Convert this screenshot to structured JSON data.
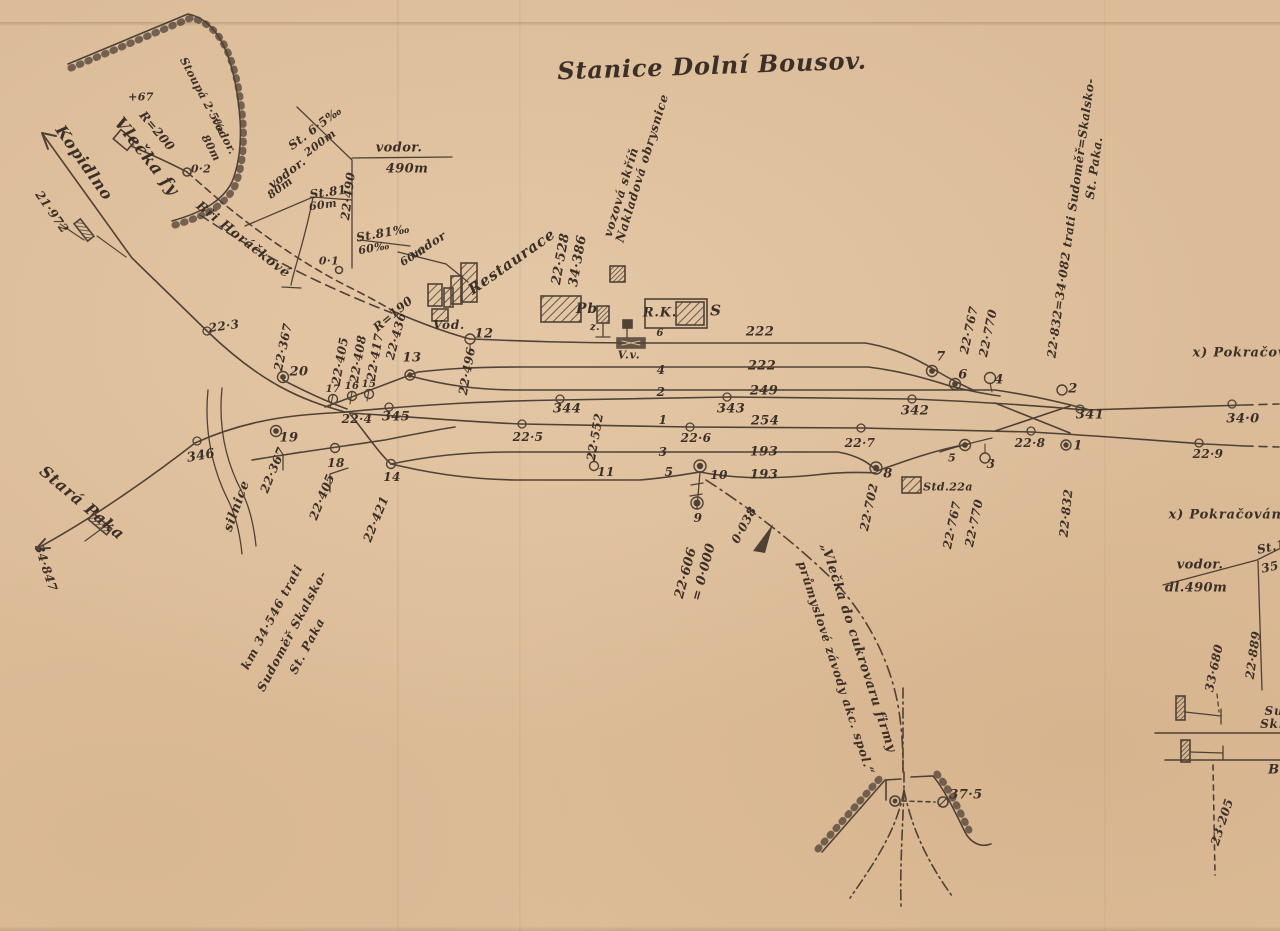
{
  "diagram": {
    "title": "Stanice Dolní Bousov.",
    "paper_color": "#dcbc98",
    "ink_color": "#3b3129",
    "type": "railway-station-track-plan"
  },
  "labels": {
    "title": "Stanice Dolní Bousov.",
    "kopidlno": "Kopidlno",
    "km_21_972": "21·972",
    "vlecka_fy": "Vlečka fy",
    "r_200": "R=200",
    "plus_67": "+67",
    "stoupa_2_5": "Stoupá 2·5‰",
    "vodor_a": "vodor.",
    "m_80_a": "80m",
    "bri_horackove": "Bři Horáčkové",
    "st_6_5": "St. 6·5‰",
    "m_200": "200m",
    "vodor_b": "vodor.",
    "m_490": "490m",
    "vodor_c": "vodor.",
    "m_80_b": "80m",
    "st_81_a": "St.81",
    "m_60_a": "60m",
    "km_22_490": "22·490",
    "st_81_b": "St.81‰",
    "per_60": "60‰",
    "vodor_d": "vodor",
    "m_60_b": "60m",
    "p_0_1": "0·1",
    "p_0_2": "0·2",
    "restaurace": "Restaurace",
    "km_22_528": "22·528",
    "km_34_386": "34·386",
    "vozova_skrin": "vozová skříň",
    "nakladova_obrysnice": "Nakladová obrysnice",
    "vod": "Vod.",
    "r_190": "R=190",
    "pb": "Pb",
    "z": "z.",
    "rk": "R.K.",
    "s": "S",
    "n6_small": "6",
    "vv": "V.v.",
    "km_22_3": "22·3",
    "km_22_367_a": "22·367",
    "km_22_405_a": "22·405",
    "km_22_408": "22·408",
    "km_22_417": "22·417",
    "km_22_436": "22·436",
    "km_22_496": "22·496",
    "km_22_4": "22·4",
    "post_346": "346",
    "post_345": "345",
    "post_344": "344",
    "post_343": "343",
    "post_342": "342",
    "post_341": "341",
    "post_34_0": "34·0",
    "km_22_5": "22·5",
    "km_22_552": "22·552",
    "km_22_6": "22·6",
    "km_22_7": "22·7",
    "km_22_8": "22·8",
    "km_22_9": "22·9",
    "pt_20": "20",
    "pt_19": "19",
    "pt_18": "18",
    "pt_17": "17",
    "pt_16": "16",
    "pt_15": "15",
    "pt_14": "14",
    "pt_13": "13",
    "pt_12": "12",
    "pt_11": "11",
    "pt_10": "10",
    "pt_9": "9",
    "pt_8": "8",
    "pt_7": "7",
    "pt_6": "6",
    "pt_5": "5",
    "pt_4": "4",
    "pt_3": "3",
    "pt_2": "2",
    "pt_1": "1",
    "trk_1": "1",
    "trk_2": "2",
    "trk_3": "3",
    "trk_4": "4",
    "trk_5": "5",
    "len_222_a": "222",
    "len_222_b": "222",
    "len_249": "249",
    "len_254": "254",
    "len_193_a": "193",
    "len_193_b": "193",
    "km_22_767_a": "22·767",
    "km_22_770_a": "22·770",
    "km_22_767_b": "22·767",
    "km_22_770_b": "22·770",
    "km_22_832_eq": "22·832=34·082 trati Sudoměř=Skalsko-",
    "st_paka_r": "St. Paka.",
    "km_22_832": "22·832",
    "km_22_702": "22·702",
    "std_22a": "Std.22a",
    "pokracovani_a": "x) Pokračování",
    "pokracovani_b": "x) Pokračování",
    "km_22_606": "22·606",
    "eq_0_000": "= 0·000",
    "n_0_038": "0·038",
    "vlecka_cukrovar": "„Vlečka do cukrovaru firmy",
    "prumyslove": "průmyslové závody akc. spol.“",
    "km_37_5": "37·5",
    "km_23_205": "23·205",
    "vodor_dl": "vodor.",
    "dl_490m": "dl.490m",
    "st_1": "St.1",
    "n_35": "35",
    "km_33_680": "33·680",
    "km_22_889": "22·889",
    "su": "Su",
    "sk": "Sk:",
    "b": "B",
    "silnice": "silnice",
    "km_22_367_b": "22·367",
    "km_22_405_b": "22·405",
    "km_22_421": "22·421",
    "stara_paka": "Stará Paka",
    "km_34_847": "34·847",
    "km_34_546": "km 34·546 trati",
    "sudomer_skalsko": "Sudoměř Skalsko-",
    "st_paka_l": "St. Paka"
  }
}
